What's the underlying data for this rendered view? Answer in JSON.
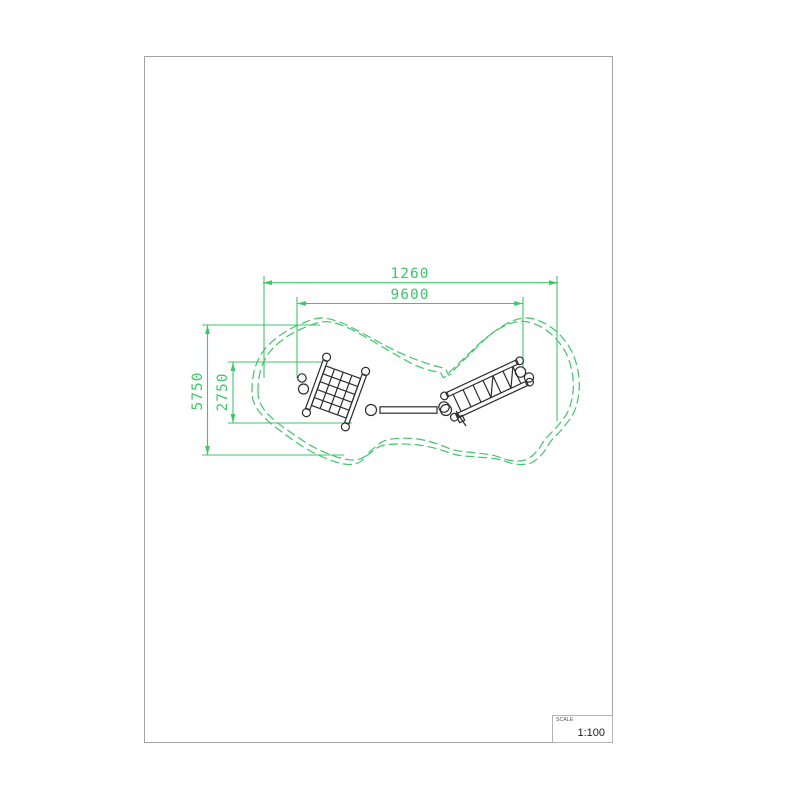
{
  "sheet": {
    "background": "#ffffff",
    "border_color": "#a3a3a3"
  },
  "drawing": {
    "colors": {
      "dimension_green": "#3fc56a",
      "equipment_black": "#2d2d2d"
    },
    "dimensions": {
      "total_width": {
        "label": "1260"
      },
      "inner_width": {
        "label": "9600"
      },
      "total_height": {
        "label": "5750"
      },
      "inner_height": {
        "label": "2750"
      }
    },
    "elements": [
      "safety-area-outline",
      "net-climber-left",
      "balance-beam",
      "net-climber-right"
    ]
  },
  "title_block": {
    "scale_label": "SCALE",
    "scale_value": "1:100"
  }
}
